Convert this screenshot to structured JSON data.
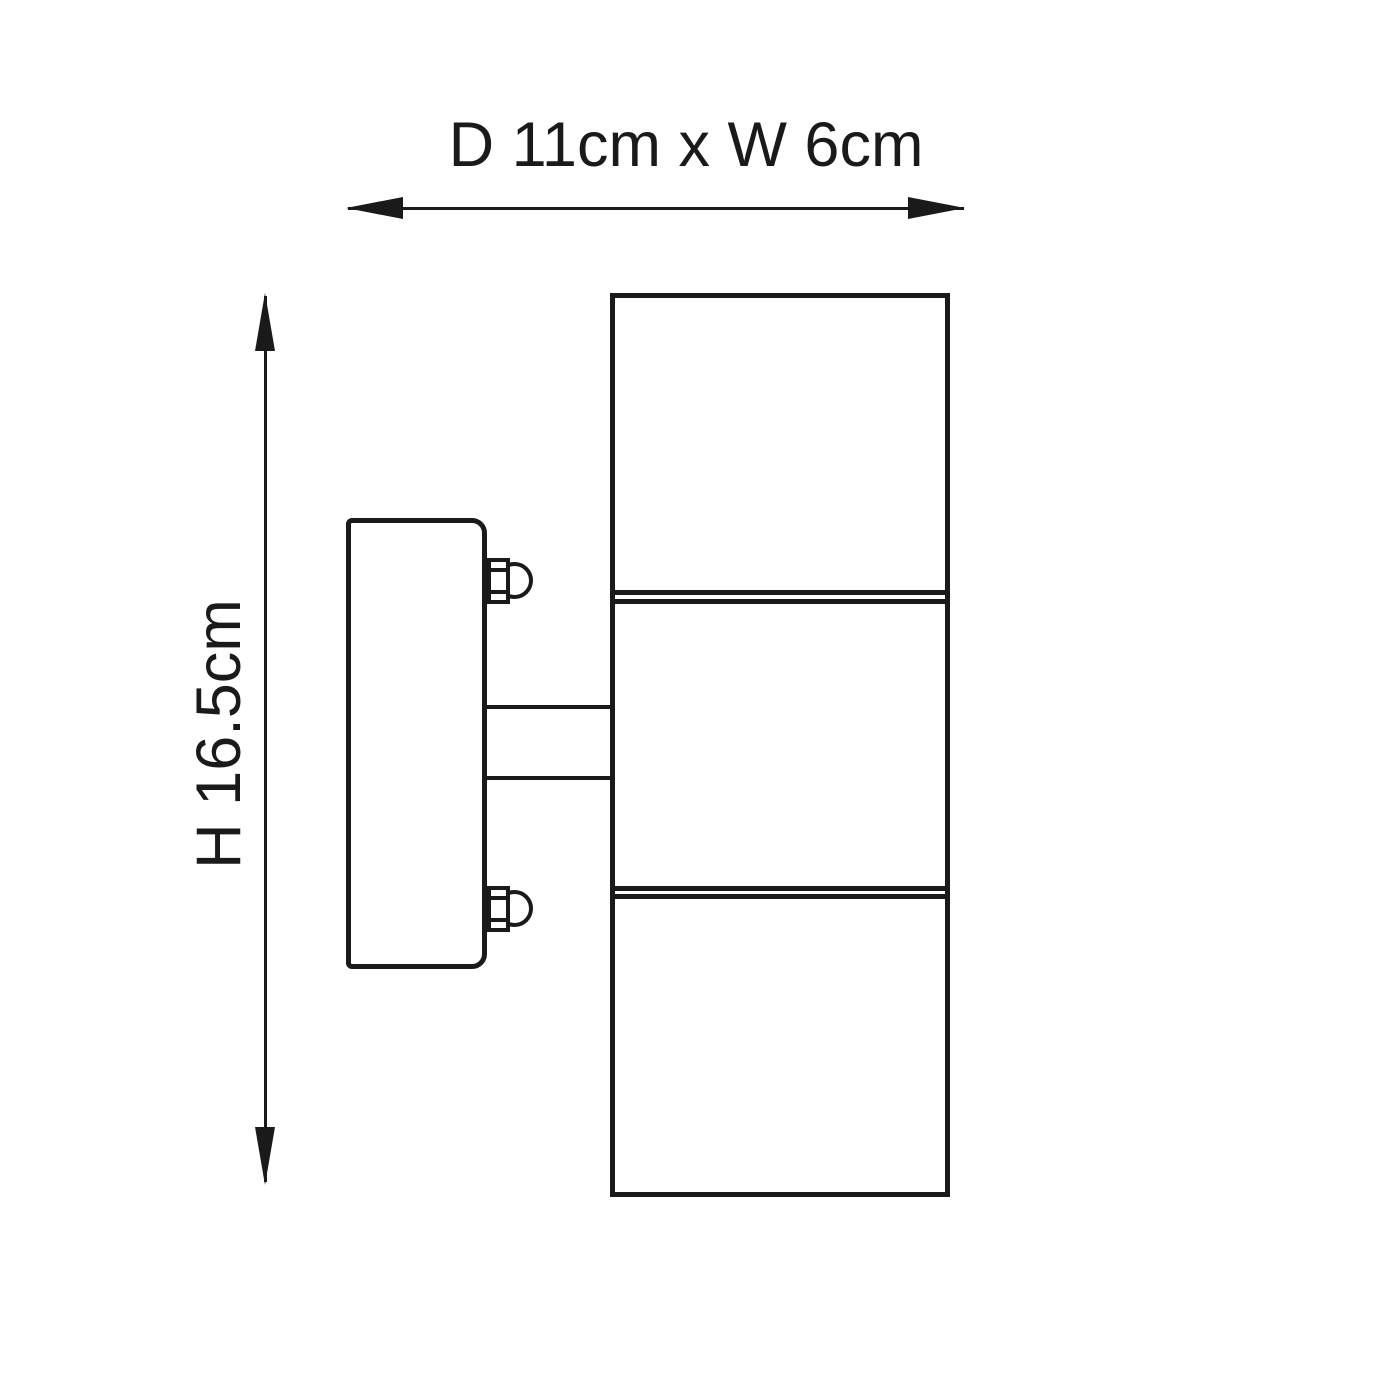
{
  "theme": {
    "line_color": "#1a1a1a",
    "background": "#ffffff"
  },
  "dimensions": {
    "width_label": "D 11cm x W 6cm",
    "height_label": "H 16.5cm"
  }
}
